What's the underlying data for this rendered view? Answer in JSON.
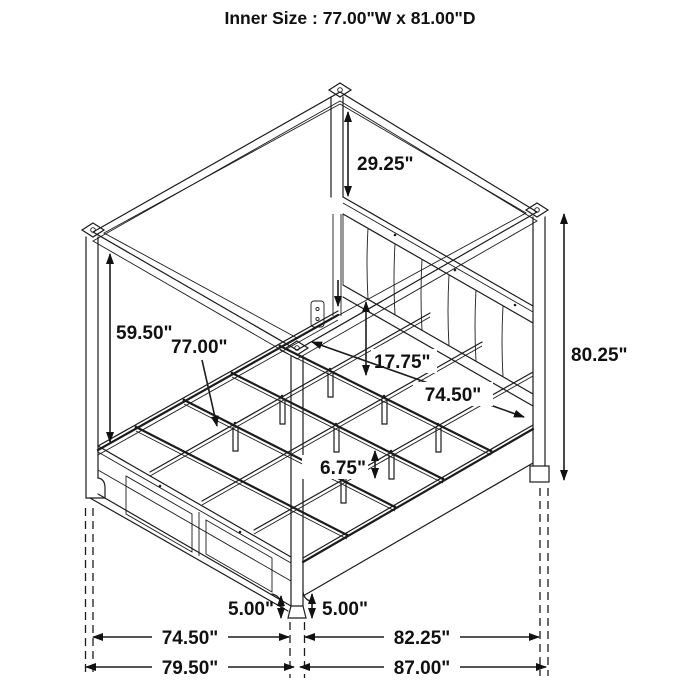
{
  "title": "Inner Size : 77.00\"W x 81.00\"D",
  "dims": {
    "canopy_to_headboard": "29.25\"",
    "rail_to_canopy": "59.50\"",
    "slat_width": "77.00\"",
    "headboard_clearance": "17.75\"",
    "inner_span": "74.50\"",
    "leg_height": "6.75\"",
    "total_height": "80.25\"",
    "floor_clearance_left": "5.00\"",
    "floor_clearance_right": "5.00\"",
    "post_span_width": "74.50\"",
    "post_span_depth": "82.25\"",
    "outer_width": "79.50\"",
    "outer_depth": "87.00\""
  }
}
